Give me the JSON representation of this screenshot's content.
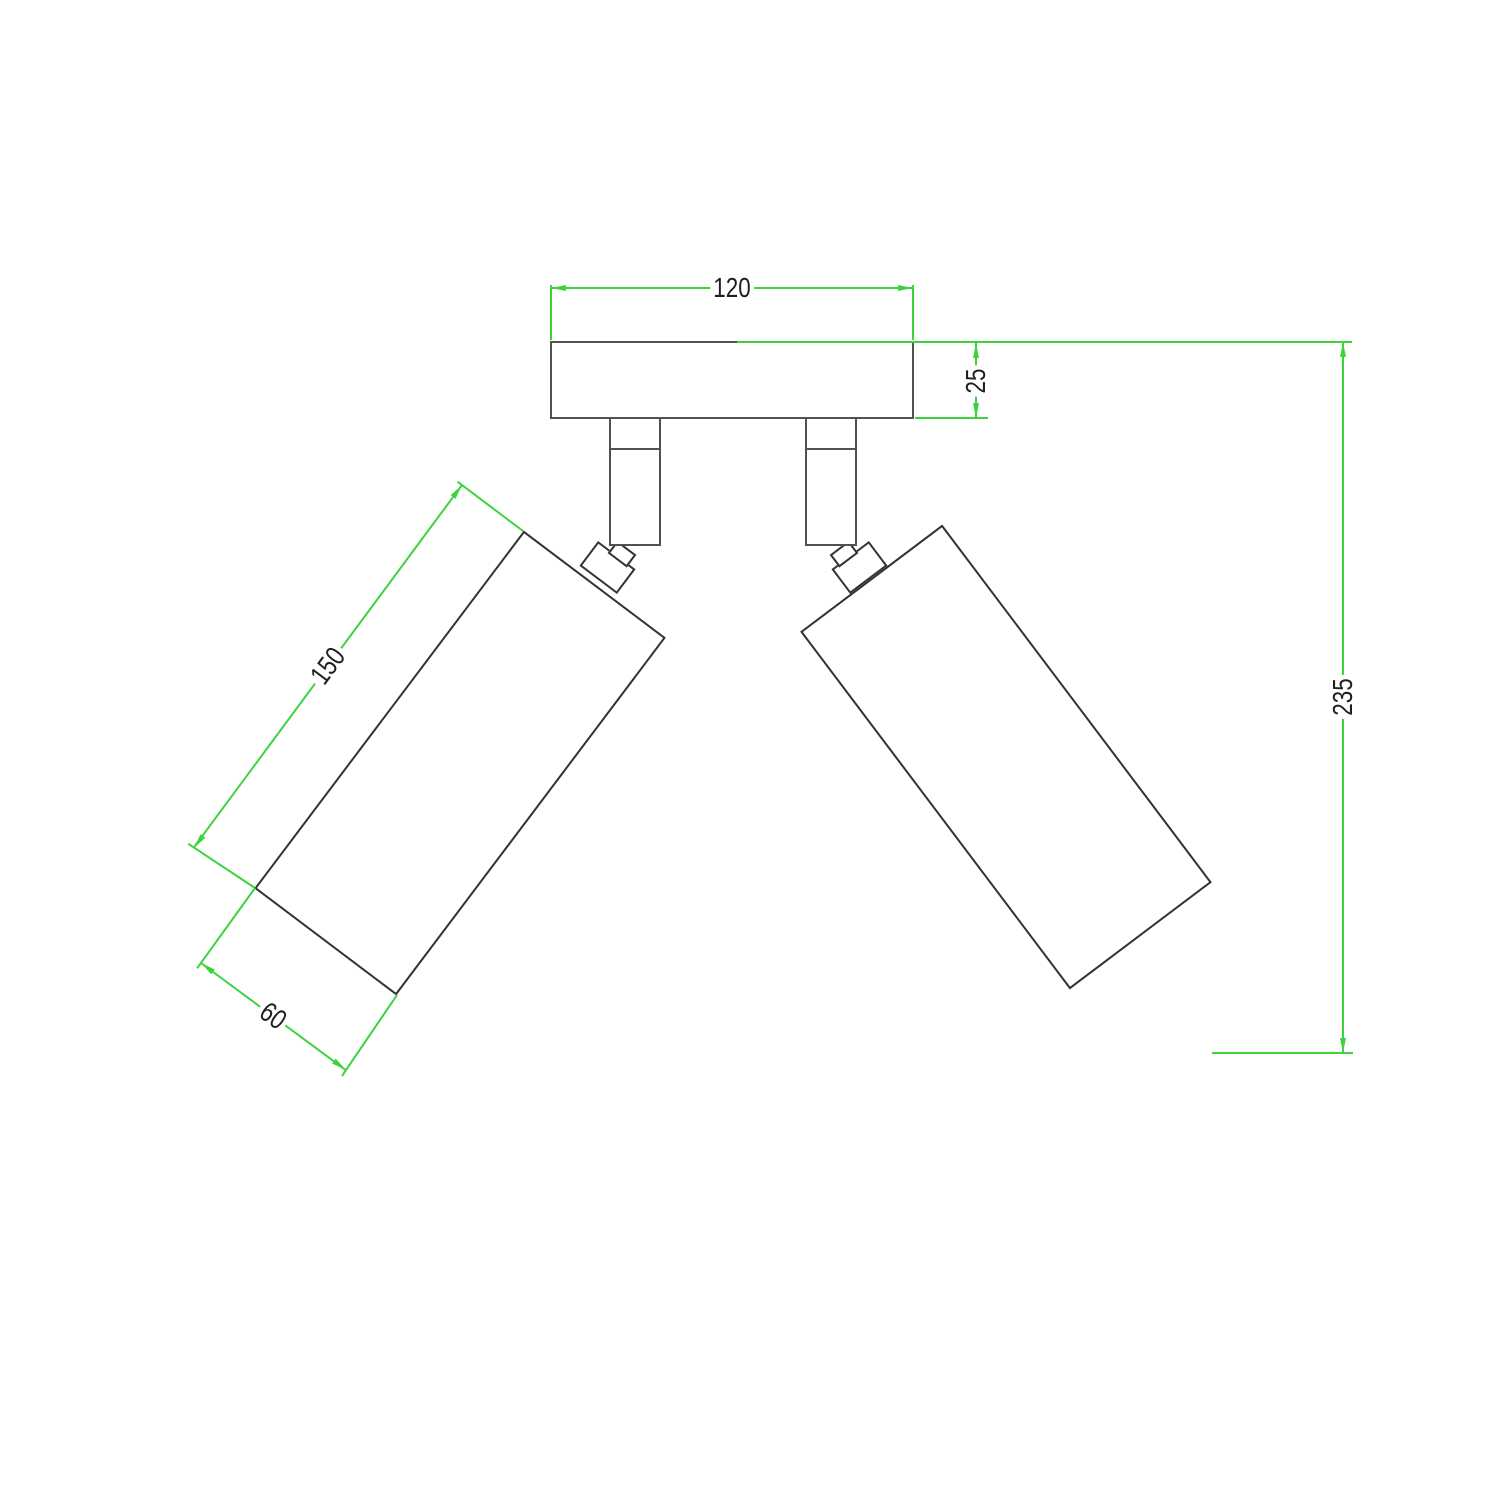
{
  "drawing": {
    "type": "technical-dimension-drawing",
    "subject": "ceiling mount with two adjustable cylindrical spotlights",
    "dimensions": {
      "plate_width": "120",
      "plate_depth": "25",
      "spot_length": "150",
      "spot_diameter": "60",
      "overall_height": "235"
    },
    "colors": {
      "dimension_line": "#3fd23f",
      "outline": "#515151",
      "outline_dark": "#333333",
      "label_text": "#1f1f1f",
      "background": "#ffffff"
    }
  }
}
